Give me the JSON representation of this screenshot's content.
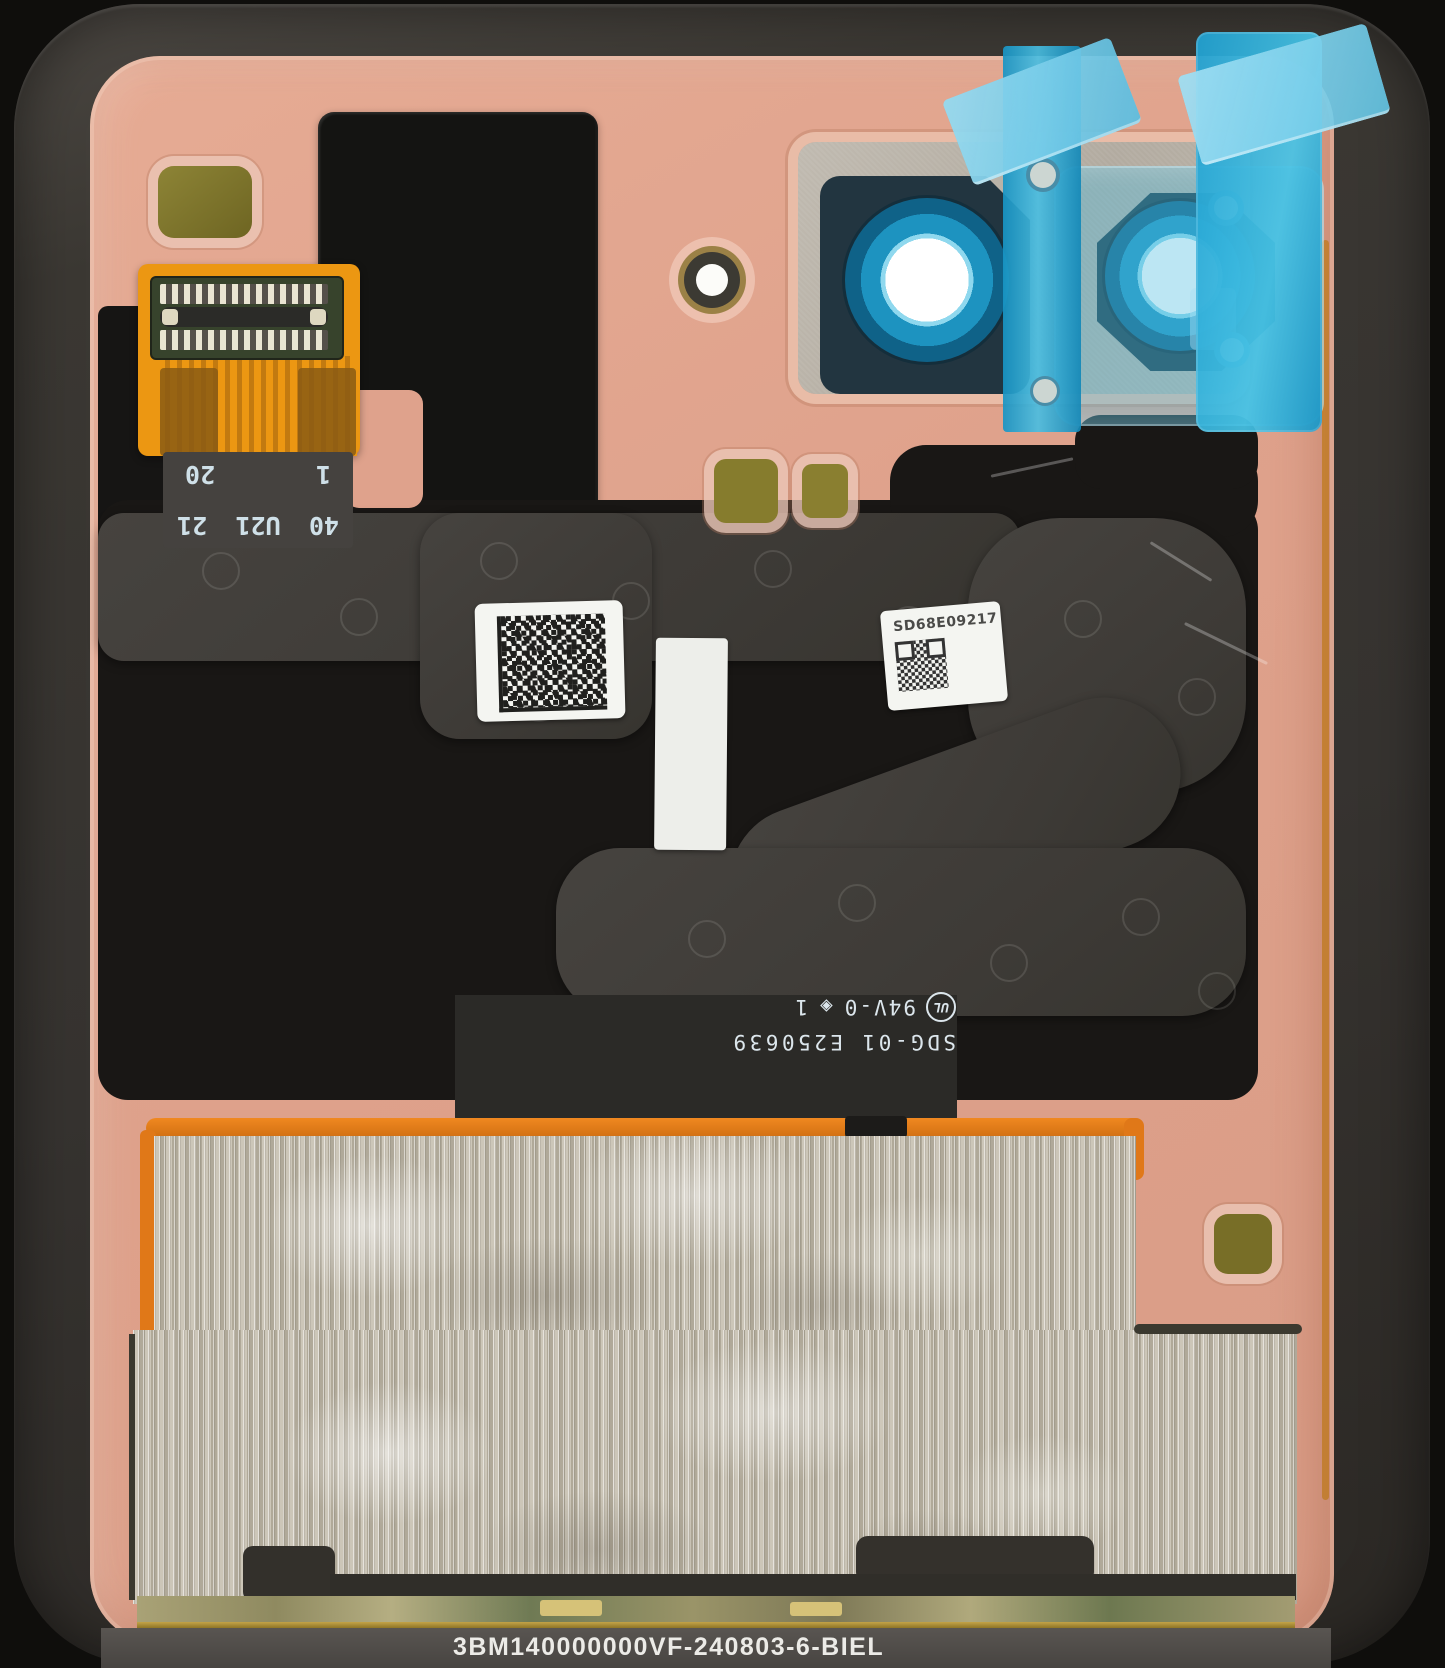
{
  "fpc": {
    "row1": [
      "40",
      "U21",
      "21"
    ],
    "row2": [
      "1",
      "20"
    ]
  },
  "labels": {
    "serial": "SD68E09217",
    "ul_mark": "UL",
    "flammability_rating": "94V-0",
    "diamond_mark": "◈",
    "rating_suffix": "1",
    "board_code": "SDG-01 E250639"
  },
  "bottom_bar": {
    "part_number": "3BM140000000VF-240803-6-BIEL"
  },
  "colors": {
    "back_panel": "#dfa28c",
    "frame": "#3a3732",
    "adhesive_black": "#191715",
    "flex_gray": "#403d39",
    "protective_film_blue": "#2aa6d2",
    "camera_ring_blue": "#1d93c0",
    "fpc_orange": "#ec9712",
    "foil_silver": "#beb8a9",
    "battery_border_orange": "#e07818",
    "gold_pad": "#867c2d"
  }
}
